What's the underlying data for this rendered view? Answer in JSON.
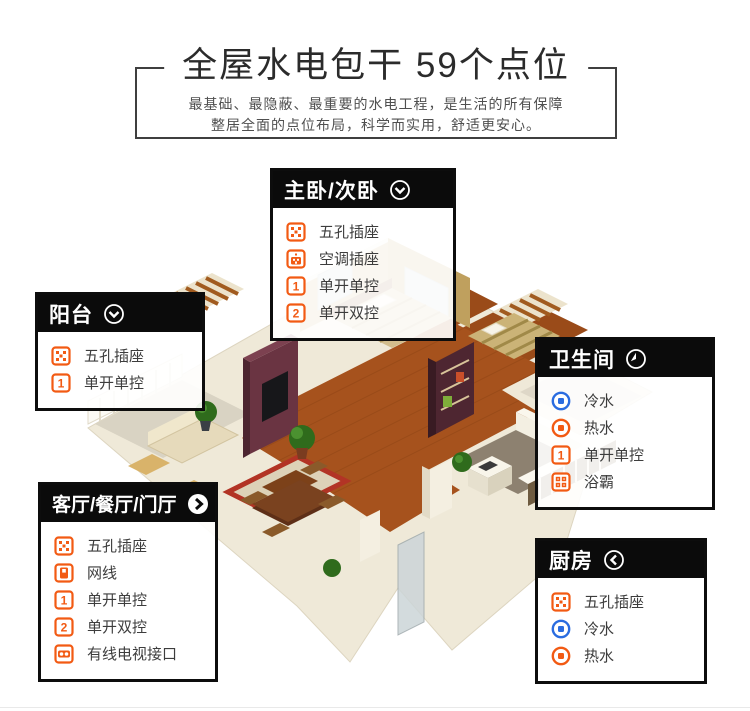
{
  "header": {
    "title": "全屋水电包干  59个点位",
    "subtitle_line1": "最基础、最隐蔽、最重要的水电工程，是生活的所有保障",
    "subtitle_line2": "整居全面的点位布局，科学而实用，舒适更安心。"
  },
  "colors": {
    "accent_orange": "#f25a13",
    "accent_blue": "#2a6ce0",
    "panel_black": "#0b0b0b",
    "frame_gray": "#3f3f3f"
  },
  "callouts": [
    {
      "id": "master-bedroom",
      "title": "主卧/次卧",
      "header_icon": "chevron-down-circle",
      "items": [
        {
          "icon": "five-hole-socket",
          "label": "五孔插座"
        },
        {
          "icon": "ac-socket",
          "label": "空调插座"
        },
        {
          "icon": "switch-1",
          "label": "单开单控"
        },
        {
          "icon": "switch-2",
          "label": "单开双控"
        }
      ]
    },
    {
      "id": "balcony",
      "title": "阳台",
      "header_icon": "chevron-down-circle",
      "items": [
        {
          "icon": "five-hole-socket",
          "label": "五孔插座"
        },
        {
          "icon": "switch-1",
          "label": "单开单控"
        }
      ]
    },
    {
      "id": "bathroom",
      "title": "卫生间",
      "header_icon": "clock-circle",
      "items": [
        {
          "icon": "cold-water",
          "label": "冷水"
        },
        {
          "icon": "hot-water",
          "label": "热水"
        },
        {
          "icon": "switch-1",
          "label": "单开单控"
        },
        {
          "icon": "bath-heater",
          "label": "浴霸"
        }
      ]
    },
    {
      "id": "living-dining-foyer",
      "title": "客厅/餐厅/门厅",
      "header_icon": "chevron-right-circle",
      "items": [
        {
          "icon": "five-hole-socket",
          "label": "五孔插座"
        },
        {
          "icon": "network-port",
          "label": "网线"
        },
        {
          "icon": "switch-1",
          "label": "单开单控"
        },
        {
          "icon": "switch-2",
          "label": "单开双控"
        },
        {
          "icon": "tv-port",
          "label": "有线电视接口"
        }
      ]
    },
    {
      "id": "kitchen",
      "title": "厨房",
      "header_icon": "chevron-left-circle",
      "items": [
        {
          "icon": "five-hole-socket",
          "label": "五孔插座"
        },
        {
          "icon": "cold-water",
          "label": "冷水"
        },
        {
          "icon": "hot-water",
          "label": "热水"
        }
      ]
    }
  ]
}
